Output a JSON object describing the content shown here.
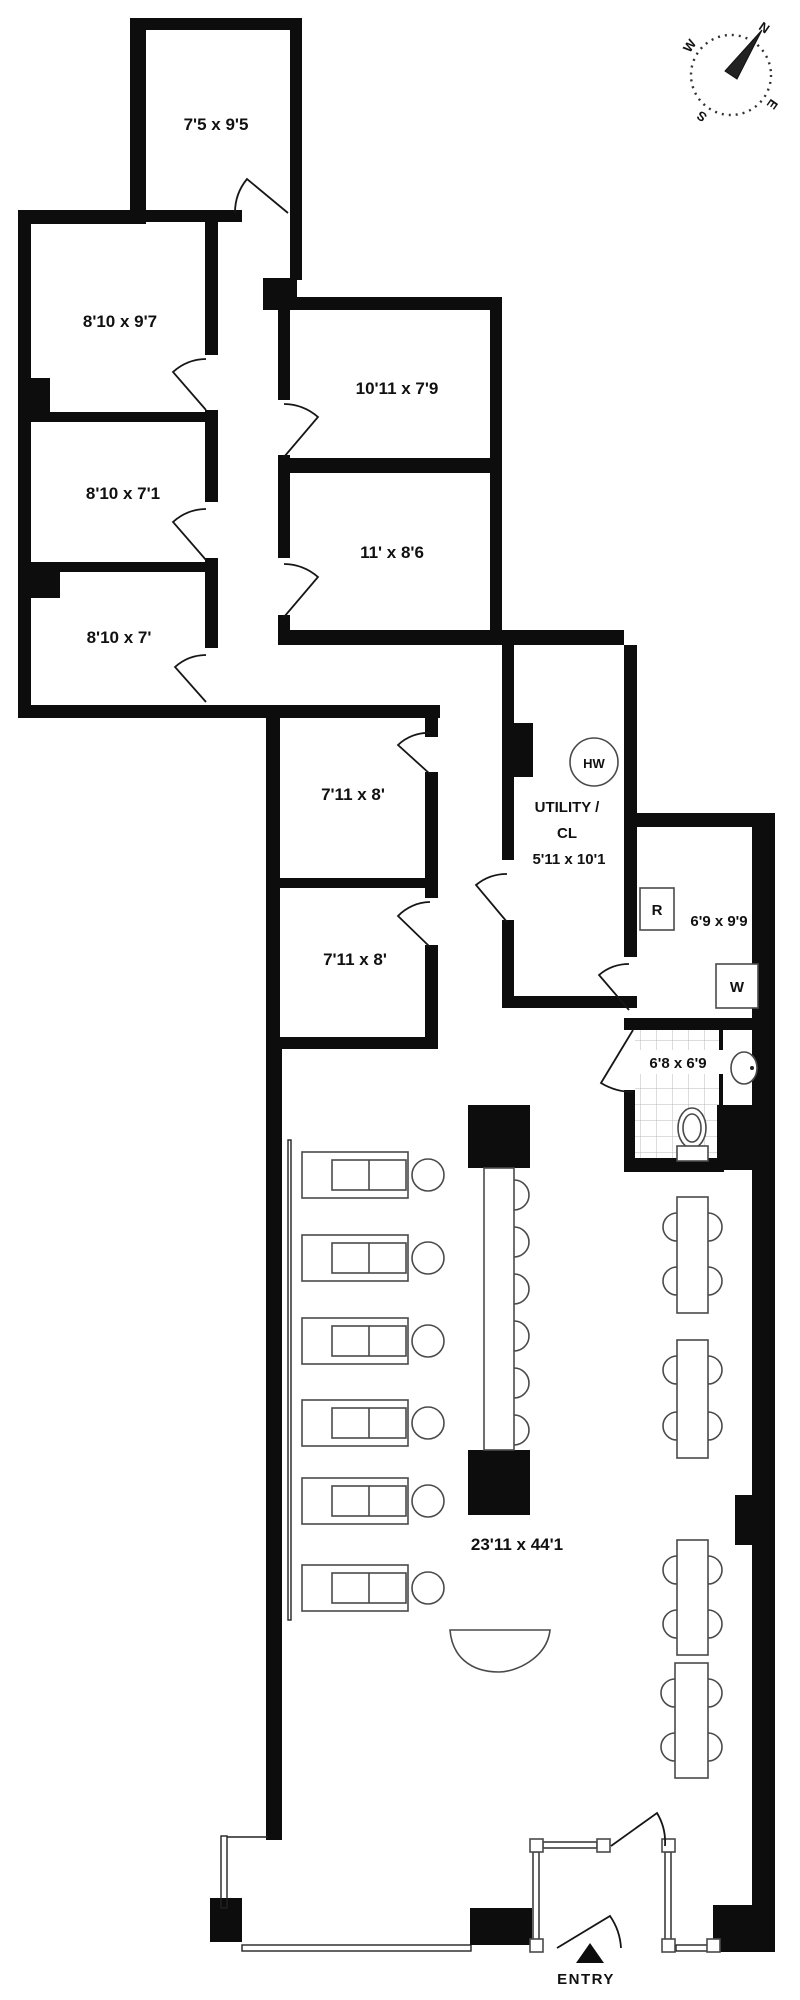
{
  "plan_title": "office-floor-plan",
  "compass": {
    "n": "N",
    "e": "E",
    "s": "S",
    "w": "W"
  },
  "labels": {
    "room_top": "7'5 x 9'5",
    "room_a": "8'10 x 9'7",
    "room_b": "8'10 x 7'1",
    "room_c": "8'10 x 7'",
    "room_d": "10'11 x 7'9",
    "room_e": "11' x 8'6",
    "room_f1": "7'11 x 8'",
    "room_f2": "7'11 x 8'",
    "utility_line1": "UTILITY /",
    "utility_line2": "CL",
    "utility_line3": "5'11 x 10'1",
    "water_heater": "HW",
    "laundry_room": "6'9 x 9'9",
    "refrigerator": "R",
    "washer": "W",
    "bathroom": "6'8 x 6'9",
    "main_room": "23'11 x 44'1",
    "entry": "ENTRY"
  },
  "colors": {
    "wall": "#0d0d0d",
    "furniture": "#4a4a4a",
    "background": "#ffffff"
  }
}
